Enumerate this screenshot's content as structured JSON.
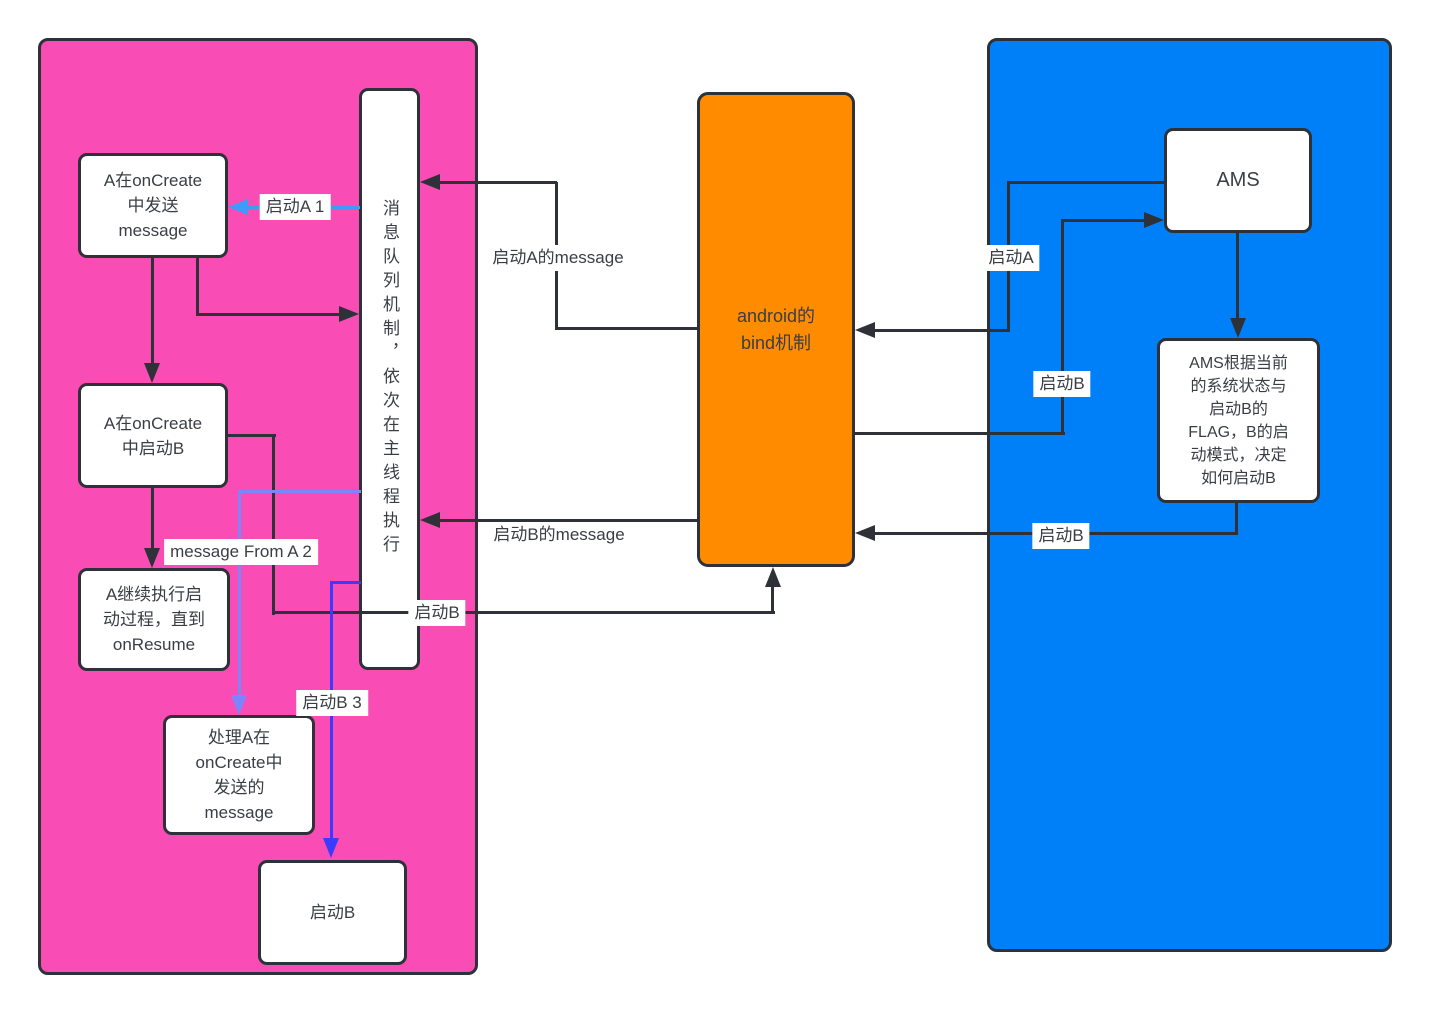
{
  "colors": {
    "pink": "#F94CB5",
    "blue": "#0080F8",
    "orange": "#FF8C00",
    "line": "#2E3238",
    "ink": "#3A3E44",
    "arrow_blue": "#3E9BFC",
    "arrow_periwinkle": "#7B86FC",
    "arrow_violet": "#3B3BFE"
  },
  "nodes": {
    "send_message": {
      "text": "A在onCreate\n中发送\nmessage"
    },
    "start_b_in_oncreate": {
      "text": "A在onCreate\n中启动B"
    },
    "continue_until_onresume": {
      "text": "A继续执行启\n动过程，直到\nonResume"
    },
    "handle_message": {
      "text": "处理A在\nonCreate中\n发送的\nmessage"
    },
    "start_b_node": {
      "text": "启动B"
    },
    "message_queue": {
      "text": "消息队列机制，依次在主线程执行"
    },
    "bind_mechanism": {
      "text": "android的\nbind机制"
    },
    "ams": {
      "text": "AMS"
    },
    "ams_decision": {
      "text": "AMS根据当前\n的系统状态与\n启动B的\nFLAG，B的启\n动模式，决定\n如何启动B"
    }
  },
  "labels": {
    "start_a_1": "启动A 1",
    "start_a_message": "启动A的message",
    "start_b_message": "启动B的message",
    "message_from_a_2": "message From A 2",
    "start_b_to_bind": "启动B",
    "start_b_3": "启动B 3",
    "start_a_from_ams": "启动A",
    "start_b_to_ams": "启动B",
    "start_b_from_decision": "启动B"
  }
}
